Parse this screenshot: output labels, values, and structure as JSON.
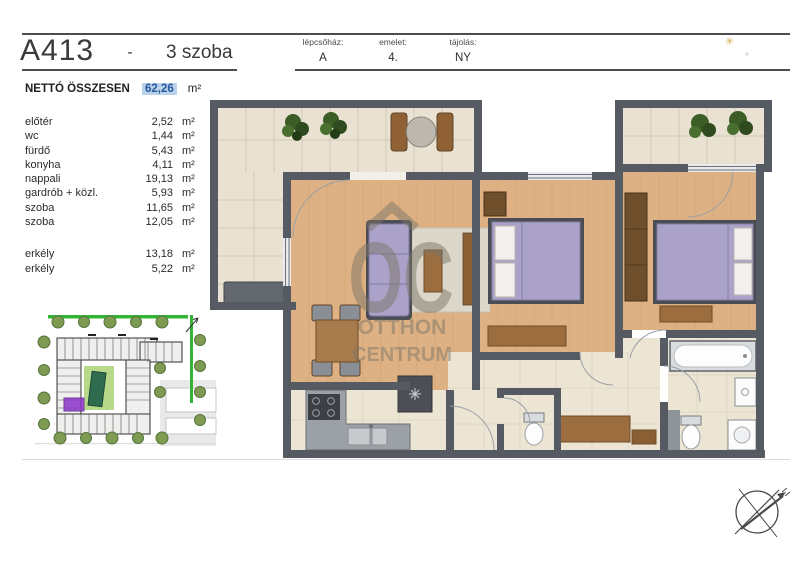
{
  "page": {
    "title": "A413",
    "separator": "-",
    "room_count": "3 szoba"
  },
  "info_table": {
    "columns": [
      {
        "label": "lépcsőház:",
        "value": "A"
      },
      {
        "label": "emelet:",
        "value": "4."
      },
      {
        "label": "tájolás:",
        "value": "NY"
      }
    ]
  },
  "net_total": {
    "label": "NETTÓ ÖSSZESEN",
    "value": "62,26",
    "unit": "m²",
    "highlight_bg": "#b9d1e9",
    "highlight_text": "#28589d"
  },
  "rooms": [
    {
      "name": "előtér",
      "area": "2,52",
      "unit": "m²"
    },
    {
      "name": "wc",
      "area": "1,44",
      "unit": "m²"
    },
    {
      "name": "fürdő",
      "area": "5,43",
      "unit": "m²"
    },
    {
      "name": "konyha",
      "area": "4,11",
      "unit": "m²"
    },
    {
      "name": "nappali",
      "area": "19,13",
      "unit": "m²"
    },
    {
      "name": "gardrób + közl.",
      "area": "5,93",
      "unit": "m²"
    },
    {
      "name": "szoba",
      "area": "11,65",
      "unit": "m²"
    },
    {
      "name": "szoba",
      "area": "12,05",
      "unit": "m²"
    }
  ],
  "balconies": [
    {
      "name": "erkély",
      "area": "13,18",
      "unit": "m²"
    },
    {
      "name": "erkély",
      "area": "5,22",
      "unit": "m²"
    }
  ],
  "watermark": {
    "logo": "OC",
    "line1": "OTTHON",
    "line2": "CENTRUM"
  },
  "icons": {
    "sparkle": "✳"
  },
  "colors": {
    "wall": "#565b63",
    "wood_floor": "#ddb183",
    "tile_floor": "#e9e2d2",
    "furniture_purple": "#aaa2c8",
    "furniture_wood": "#9c6d3e",
    "kitchen_gray": "#9ca0a7",
    "plant_green": "#3c5d26",
    "site_boundary_green": "#33b433",
    "site_unit_purple": "#8b34c9",
    "accent_gold": "#c9a33a"
  }
}
